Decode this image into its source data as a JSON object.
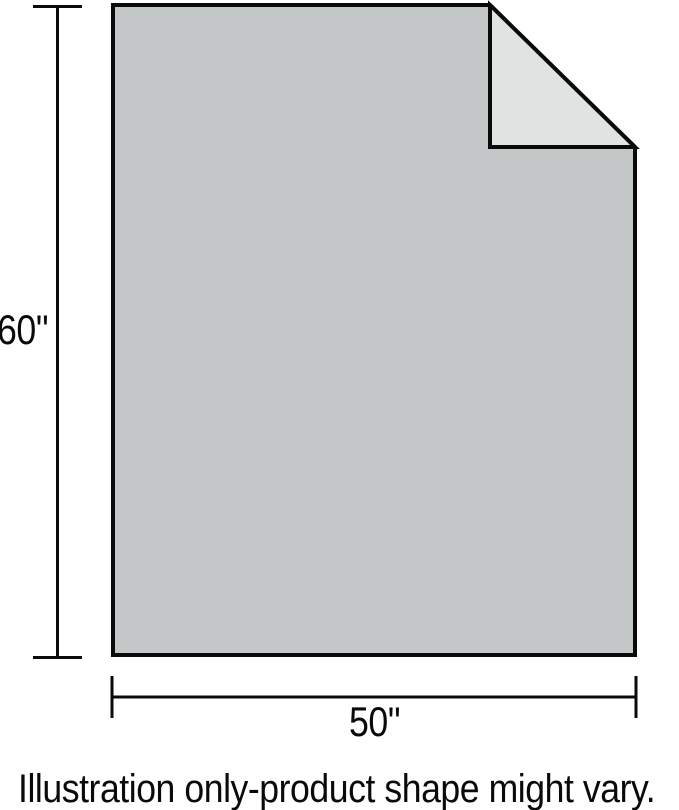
{
  "labels": {
    "height": "60\"",
    "width": "50\""
  },
  "caption": "Illustration only-product shape might vary.",
  "icons": {
    "sheet_shape": "blanket-with-folded-corner"
  },
  "colors": {
    "sheet_fill": "#c3c7c7",
    "fold_fill": "#dfe3e2",
    "outline": "#0a0a0a",
    "background": "#ffffff"
  }
}
